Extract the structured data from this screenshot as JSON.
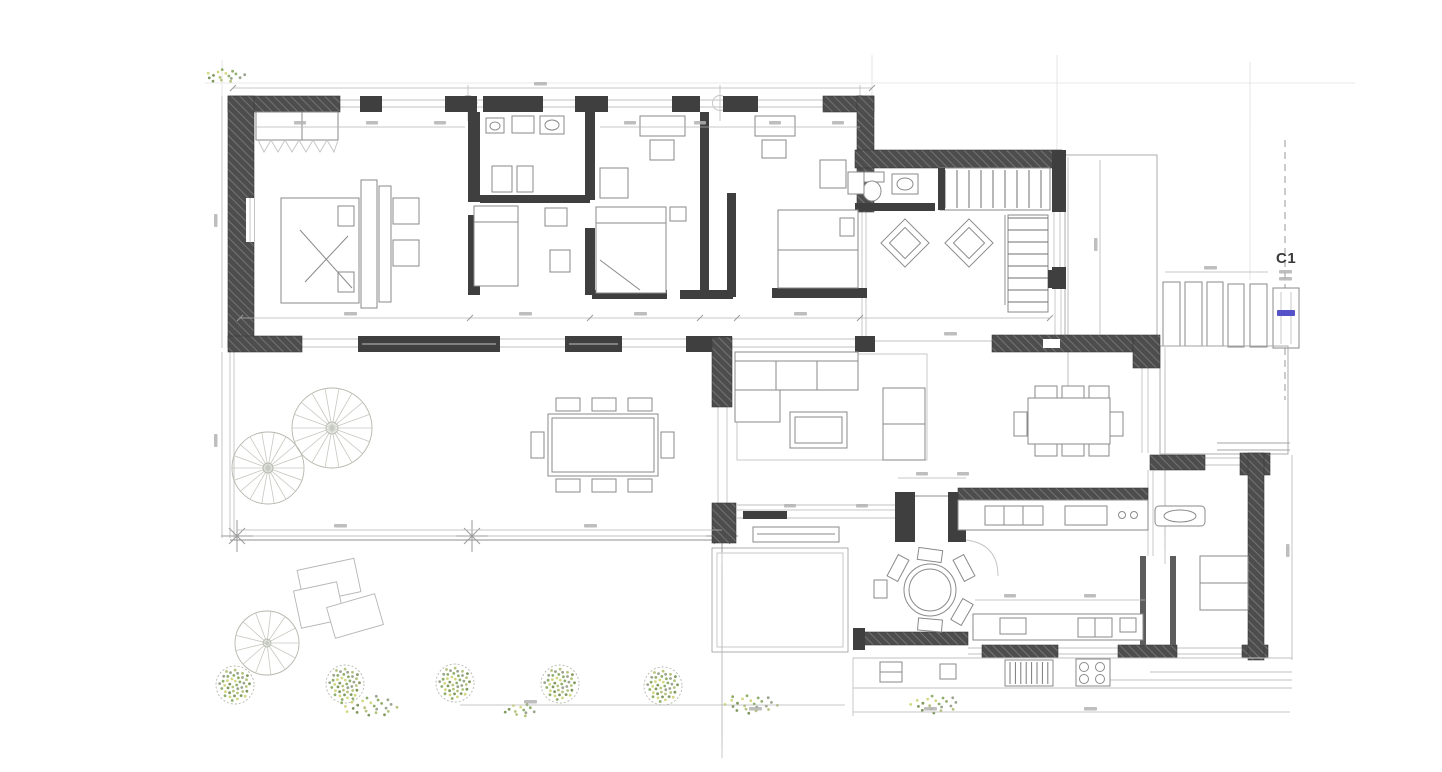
{
  "plan": {
    "kind": "architectural-floor-plan",
    "section_marker": {
      "label": "C1",
      "accent_color": "#5551c8"
    },
    "palette": {
      "paper": "#ffffff",
      "wall": "#3f3f3f",
      "linework": "#8f8f8f",
      "light_linework": "#c2c2c2",
      "dimension": "#b5b5b5",
      "vegetation_green": "#8fae6b",
      "vegetation_yellow": "#d2d982",
      "accent_blue": "#5551c8"
    },
    "site": {
      "garden_trees": 5,
      "terrace_fan_trees": 2,
      "stepping_pavers": 5,
      "wood_decks": 3,
      "spiral_stair": 1
    }
  }
}
